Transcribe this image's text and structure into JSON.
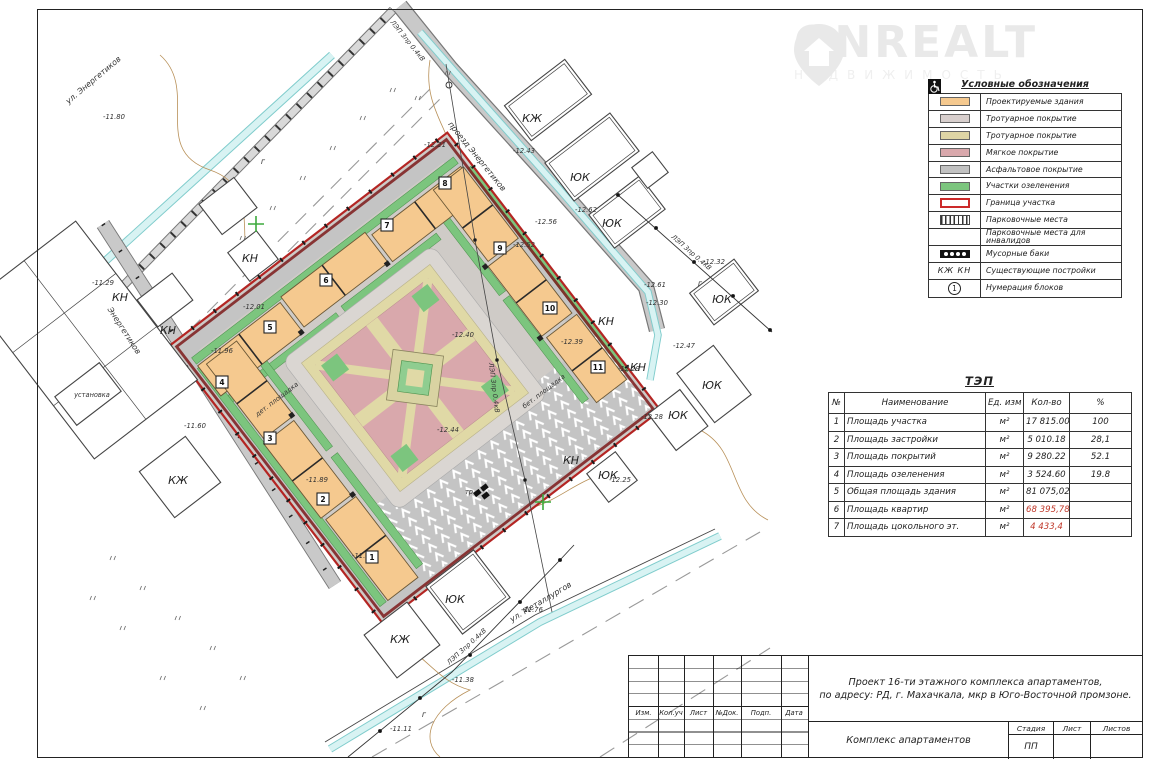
{
  "watermark": {
    "brand": "ONREALT",
    "subtitle": "НЕДВИЖИМОСТЬ"
  },
  "legend": {
    "title": "Условные обозначения",
    "items": [
      {
        "label": "Проектируемые здания"
      },
      {
        "label": "Тротуарное покрытие"
      },
      {
        "label": "Тротуарное покрытие"
      },
      {
        "label": "Мягкое покрытие"
      },
      {
        "label": "Асфальтовое покрытие"
      },
      {
        "label": "Участки озеленения"
      },
      {
        "label": "Граница участка"
      },
      {
        "label": "Парковочные места"
      },
      {
        "label": "Парковочные места для инвалидов"
      },
      {
        "label": "Мусорные баки"
      },
      {
        "label": "Существующие постройки",
        "key": "КЖ   КН"
      },
      {
        "label": "Нумерация блоков",
        "key": "1"
      }
    ]
  },
  "tep": {
    "title": "ТЭП",
    "headers": {
      "num": "№",
      "name": "Наименование",
      "unit": "Ед. изм",
      "qty": "Кол-во",
      "pct": "%"
    },
    "unit": "м²",
    "rows": [
      {
        "num": "1",
        "name": "Площадь участка",
        "qty": "17 815.00",
        "pct": "100"
      },
      {
        "num": "2",
        "name": "Площадь застройки",
        "qty": "5 010.18",
        "pct": "28,1"
      },
      {
        "num": "3",
        "name": "Площадь покрытий",
        "qty": "9 280.22",
        "pct": "52.1"
      },
      {
        "num": "4",
        "name": "Площадь озеленения",
        "qty": "3 524.60",
        "pct": "19.8"
      },
      {
        "num": "5",
        "name": "Общая площадь здания",
        "qty": "81 075,02",
        "pct": ""
      },
      {
        "num": "6",
        "name": "Площадь квартир",
        "qty": "68 395,78",
        "pct": ""
      },
      {
        "num": "7",
        "name": "Площадь цокольного эт.",
        "qty": "4 433,4",
        "pct": ""
      }
    ]
  },
  "title_block": {
    "cols": [
      "Изм.",
      "Кол.уч",
      "Лист",
      "№Док.",
      "Подп.",
      "Дата"
    ],
    "project_line1": "Проект 16-ти этажного комплекса апартаментов,",
    "project_line2": "по адресу: РД, г. Махачкала, мкр в Юго-Восточной промзоне.",
    "object": "Комплекс апартаментов",
    "stage_label": "Стадия",
    "sheet_label": "Лист",
    "sheets_label": "Листов",
    "stage_value": "ПП"
  },
  "plan": {
    "streets": {
      "energetikov": "ул. Энергетиков",
      "proezd_energetikov": "проезд Энергетиков",
      "road_energetikov": "Энергетиков",
      "metallurgov": "ул. Металлургов"
    },
    "lep": "ЛЭП 3пр 0.4кВ",
    "labels": {
      "kn": "КН",
      "kzh": "КЖ",
      "yuk": "ЮК",
      "ustanovka": "установка",
      "det_ploshadka": "дет. площадка",
      "bet_ploshadka": "бет. площадка",
      "tr": "тр.",
      "g": "г"
    },
    "blocks": [
      "1",
      "2",
      "3",
      "4",
      "5",
      "6",
      "7",
      "8",
      "9",
      "10",
      "11"
    ],
    "elevations": [
      "-11.80",
      "-12.21",
      "-12.43",
      "-12.62",
      "-12.56",
      "-12.52",
      "-12.32",
      "-12.61",
      "-12.30",
      "-12.47",
      "-12.39",
      "-12.29",
      "-12.28",
      "-12.25",
      "-12.44",
      "-12.40",
      "-11.96",
      "-12.01",
      "-11.29",
      "-11.89",
      "-11.71",
      "-11.60",
      "-11.38",
      "-11.11",
      "-11.76"
    ]
  },
  "colors": {
    "building": "#f5c98f",
    "sidewalk": "#d9d3cf",
    "paving_tan": "#e0d9a6",
    "soft_pink": "#d9a8ac",
    "asphalt": "#c4c4c4",
    "green": "#7cc57e",
    "boundary_red": "#b42523",
    "stream": "#d8f3f3"
  }
}
